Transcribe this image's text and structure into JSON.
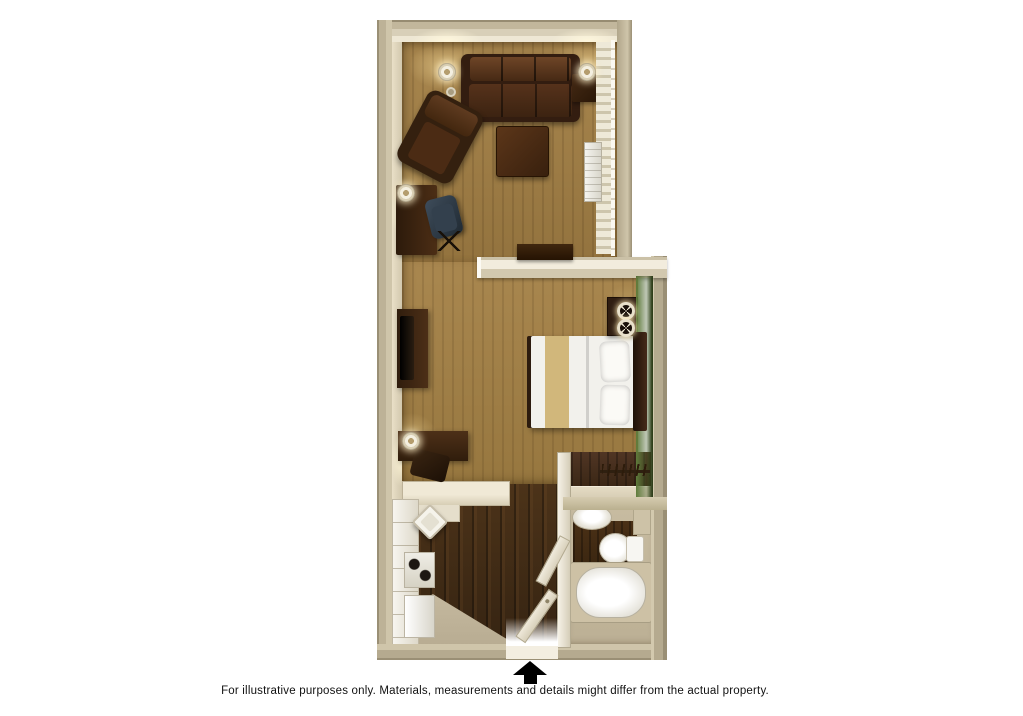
{
  "caption": {
    "text": "For illustrative purposes only.  Materials, measurements and details might differ from the actual property."
  },
  "plan": {
    "type": "3d-floor-plan-top-view",
    "entrance_marker": "black-up-arrow-icon",
    "rooms": [
      {
        "name": "living-room",
        "floor": "carpet",
        "furniture": [
          "sofa",
          "armchair",
          "coffee-table",
          "desk",
          "desk-chair",
          "side-table",
          "table-lamps",
          "console-table",
          "window-curtains",
          "ac-unit",
          "smoke-detector"
        ]
      },
      {
        "name": "bedroom",
        "floor": "carpet",
        "accent_wall": "green",
        "furniture": [
          "bed",
          "headboard",
          "pillows",
          "nightstand",
          "bedside-lamps",
          "tv-stand",
          "tv",
          "table",
          "chair",
          "table-lamp"
        ]
      },
      {
        "name": "closet",
        "floor": "dark-wood",
        "furniture": [
          "clothes-rod",
          "hangers",
          "shelf"
        ]
      },
      {
        "name": "kitchen",
        "floor": "dark-wood",
        "furniture": [
          "counter",
          "diagonal-sink",
          "stove",
          "refrigerator"
        ]
      },
      {
        "name": "bathroom",
        "floor": "mixed",
        "furniture": [
          "vanity-sink",
          "toilet",
          "bathtub",
          "bathroom-door"
        ]
      },
      {
        "name": "entry",
        "floor": "tile",
        "furniture": [
          "entry-door"
        ]
      }
    ],
    "colors": {
      "background": "#ffffff",
      "outer_wall": "#b5aa8f",
      "interior_wall": "#f2ecdd",
      "carpet": "#a08049",
      "dark_wood_floor": "#432d18",
      "accent_wall_green": "#4e6a2e",
      "furniture_wood": "#3a2315",
      "linens": "#f2f1ec",
      "text": "#111111",
      "arrow": "#000000"
    }
  }
}
